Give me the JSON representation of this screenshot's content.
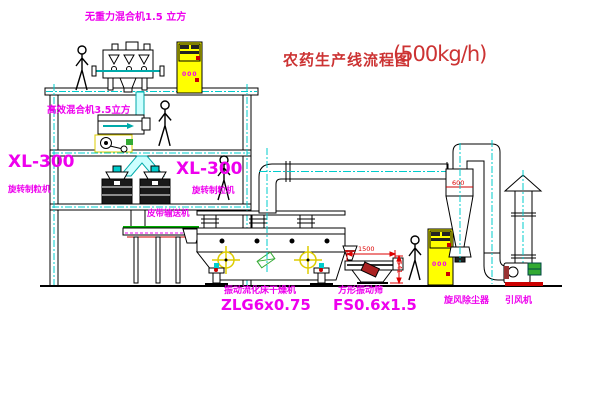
{
  "title": {
    "text": "农药生产线流程图",
    "capacity": "(500kg/h)"
  },
  "equipment": {
    "gravity_mixer": {
      "label": "无重力混合机1.5 立方"
    },
    "high_efficiency_mixer": {
      "label": "高效混合机3.5立方"
    },
    "granulator_left": {
      "model": "XL-300",
      "name": "旋转制粒机"
    },
    "granulator_right": {
      "model": "XL-300",
      "name": "旋转制粒机"
    },
    "belt_conveyor": {
      "name": "皮带输送机"
    },
    "fluid_bed_dryer": {
      "name": "振动流化床干燥机",
      "model": "ZLG6x0.75"
    },
    "vibrating_screen": {
      "name": "方形振动筛",
      "model": "FS0.6x1.5"
    },
    "cyclone": {
      "name": "旋风除尘器",
      "marking": "600"
    },
    "induced_draft_fan": {
      "name": "引风机"
    },
    "control_cabinet_upper": {
      "display": "000"
    },
    "control_cabinet_lower": {
      "display": "000"
    }
  },
  "dimensions": {
    "screen_length": "1500",
    "screen_height": "541"
  },
  "colors": {
    "label_magenta": "#ee00ee",
    "title_red": "#cc3333",
    "dimension_red": "#dd0000",
    "centerline_cyan": "#00cccc",
    "cabinet_yellow": "#ffff00",
    "motor_green": "#33aa33"
  }
}
